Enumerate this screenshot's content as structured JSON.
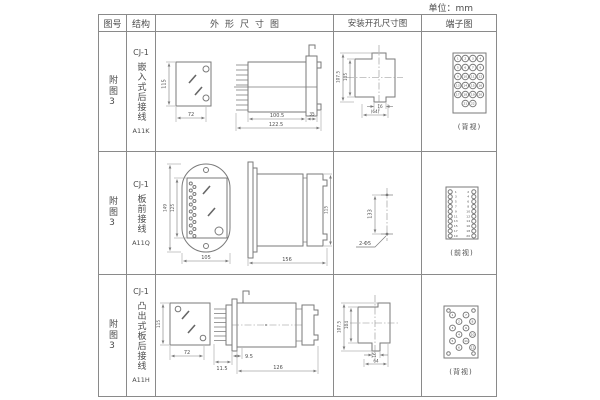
{
  "page": {
    "unit_label": "单位：mm"
  },
  "colors": {
    "line": "#7a7a7a",
    "text": "#4d4d4d",
    "border": "#8a8a8a",
    "background": "#ffffff"
  },
  "table": {
    "headers": {
      "fig": "图号",
      "structure": "结构",
      "outline": "外形尺寸图",
      "install": "安装开孔尺寸图",
      "terminal": "端子图"
    },
    "rows": [
      {
        "fig": "附图3",
        "model": "CJ-1",
        "structure": "嵌入式后接线",
        "code": "A11K",
        "outline": {
          "h": "115",
          "w": "72",
          "d_body": "100.5",
          "d_total": "122.5",
          "d_flange": "35"
        },
        "install": {
          "v1": "107.5",
          "v2": "105",
          "notch": "16",
          "w": "(64)"
        },
        "terminal": {
          "view": "(背视)",
          "numbers": [
            1,
            2,
            3,
            4,
            5,
            6,
            7,
            8,
            9,
            10,
            11,
            12,
            13,
            14,
            15,
            16,
            17,
            18,
            19,
            20,
            21,
            22
          ]
        }
      },
      {
        "fig": "附图3",
        "model": "CJ-1",
        "structure": "板前接线",
        "code": "A11Q",
        "outline": {
          "h_outer": "149",
          "h_inner": "125",
          "w": "105",
          "length": "156",
          "side_h": "115"
        },
        "install": {
          "spacing": "133",
          "holes": "2-Φ5"
        },
        "terminal": {
          "view": "(前视)",
          "left": [
            1,
            3,
            5,
            7,
            9,
            11,
            13,
            15,
            17,
            19
          ],
          "right": [
            2,
            4,
            6,
            8,
            10,
            12,
            14,
            16,
            18,
            20
          ]
        }
      },
      {
        "fig": "附图3",
        "model": "CJ-1",
        "structure": "凸出式板后接线",
        "code": "A11H",
        "outline": {
          "h": "115",
          "w": "72",
          "d1": "11.5",
          "d2": "9.5",
          "d3": "126"
        },
        "install": {
          "v1": "107.5",
          "v2": "104",
          "notch": "16",
          "w": "64"
        },
        "terminal": {
          "view": "(背视)",
          "numbers": [
            1,
            2,
            3,
            4,
            5,
            6,
            7,
            8,
            9,
            10,
            11,
            12
          ]
        }
      }
    ]
  }
}
